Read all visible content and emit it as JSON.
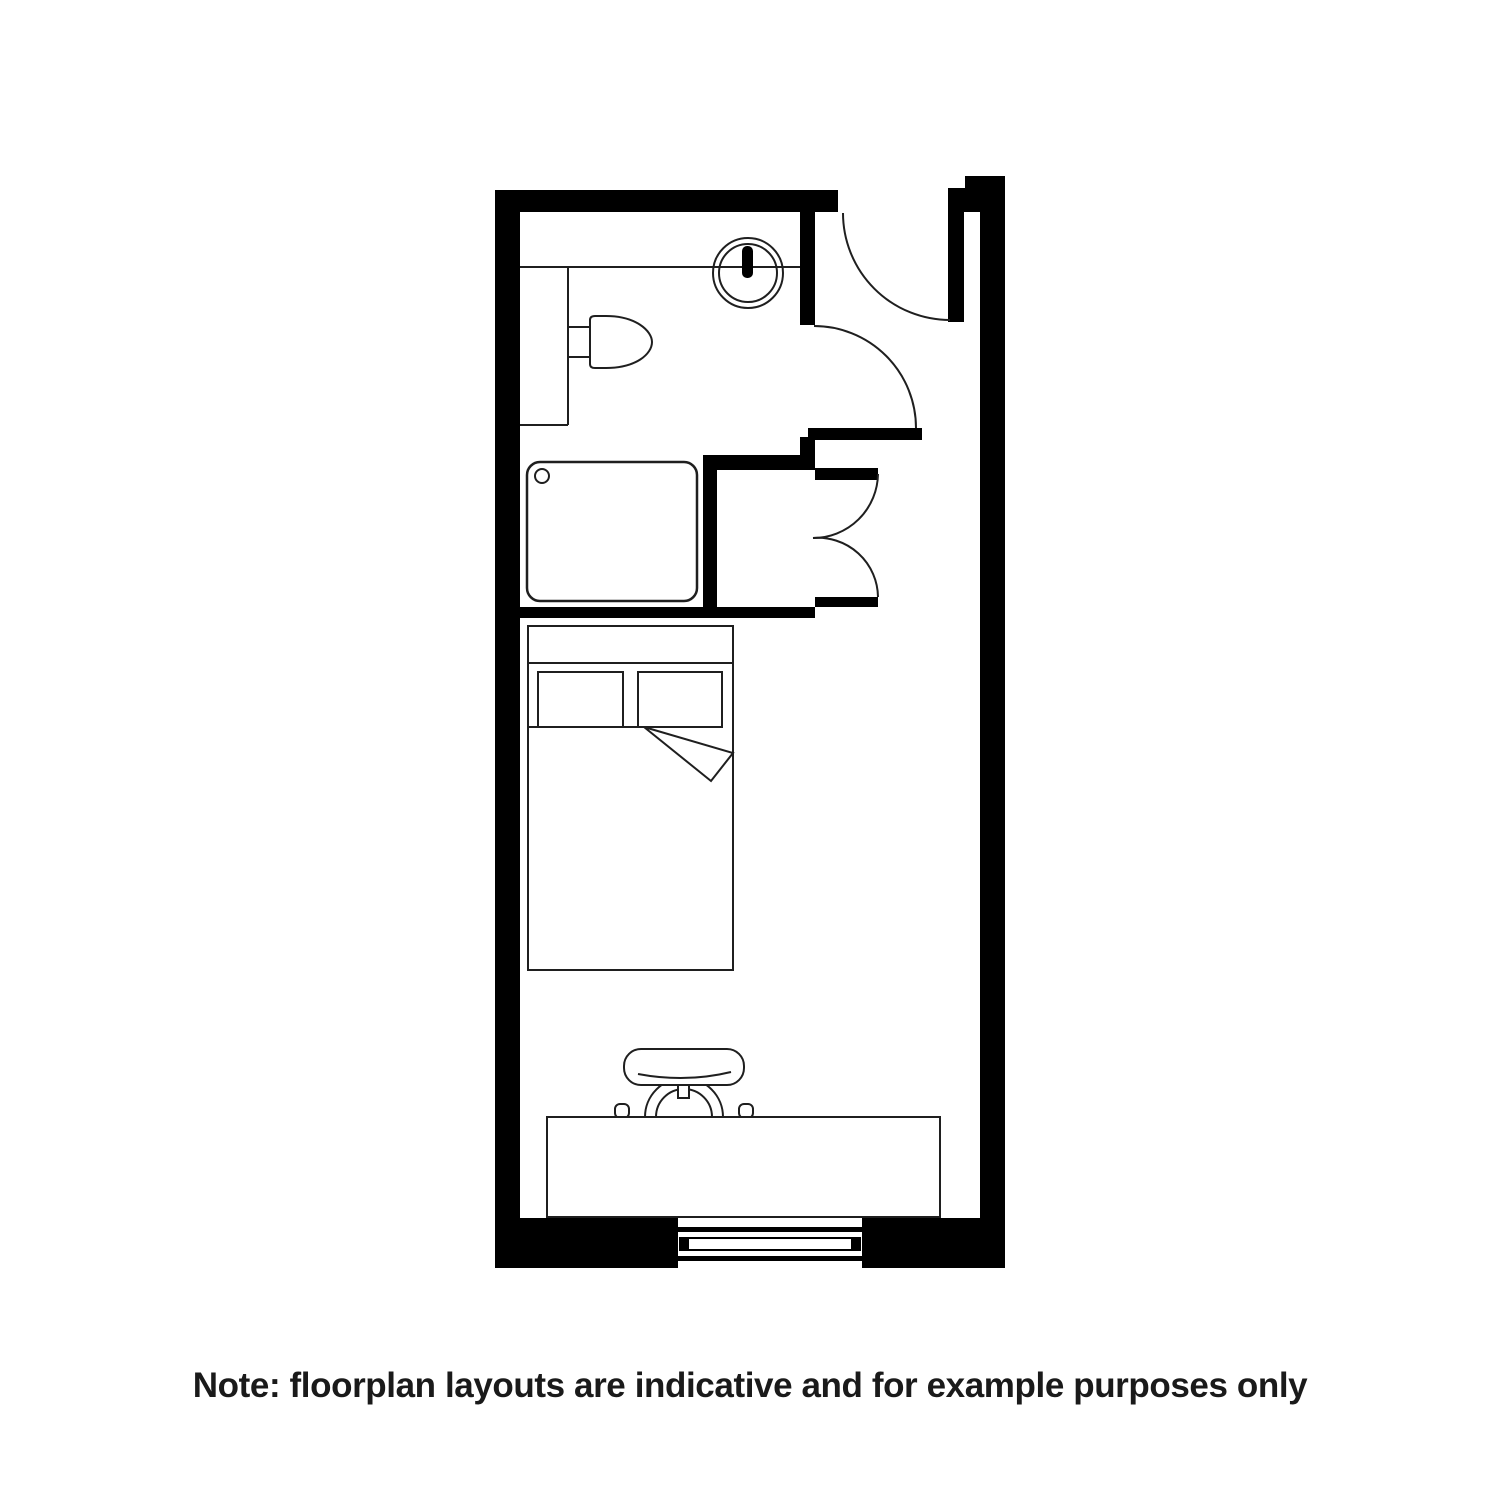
{
  "note": {
    "text": "Note: floorplan layouts are indicative and for example purposes only"
  },
  "palette": {
    "wall": "#000000",
    "background": "#ffffff",
    "fixture_line": "#1f1f1f",
    "text": "#1a1a1a"
  },
  "fixtures": {
    "entry_door": "door-swing-top-right",
    "bathroom_door": "door-swing-bathroom",
    "closet_doors": "double-bifold-doors",
    "toilet": "toilet-symbol",
    "sink": "round-basin-with-tap",
    "shower": "shower-tray-with-drain",
    "bed": "double-bed-two-pillows-folded-sheet",
    "desk": "desk",
    "chair": "task-chair",
    "window": "window-bottom-wall"
  }
}
